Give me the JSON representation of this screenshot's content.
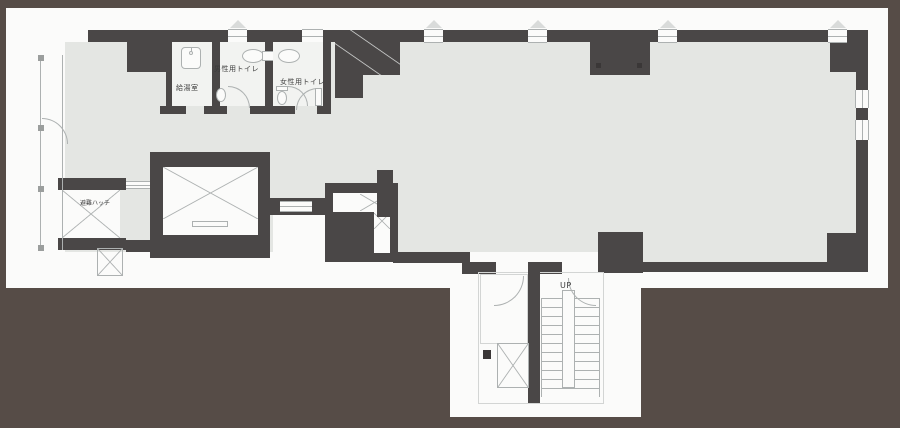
{
  "title": "office floor plan",
  "colors": {
    "bg": "#564c47",
    "sheet": "#fbfbfa",
    "wall": "#4a4747",
    "floor": "#e4e6e3",
    "room": "#f2f3f1",
    "line": "#adb1b1",
    "text": "#3c3c3c"
  },
  "labels": {
    "kitchenette": "給湯室",
    "mens_toilet": "男性用トイレ",
    "womens_toilet": "女性用トイレ",
    "evac_hatch": "避難ハッチ",
    "stairs_up": "UP"
  }
}
